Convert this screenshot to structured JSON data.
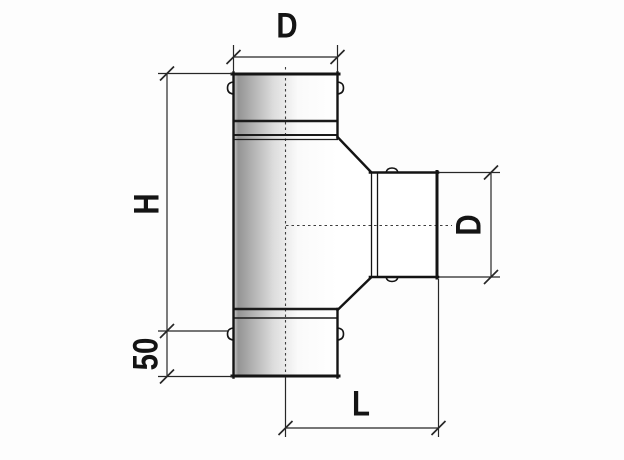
{
  "drawing": {
    "type": "engineering dimension drawing",
    "subject": "tee pipe fitting, front view",
    "labels": {
      "top_diameter": "D",
      "height": "H",
      "branch_diameter": "D",
      "bottom_section": "50",
      "branch_length": "L"
    },
    "dimensions": [
      {
        "label": "D",
        "position": "top",
        "orientation": "horizontal"
      },
      {
        "label": "H",
        "position": "left",
        "orientation": "vertical"
      },
      {
        "label": "D",
        "position": "right",
        "orientation": "vertical"
      },
      {
        "label": "50",
        "position": "lower-left",
        "orientation": "vertical"
      },
      {
        "label": "L",
        "position": "bottom",
        "orientation": "horizontal"
      }
    ],
    "colors": {
      "background": "#fdfdfd",
      "outline": "#161616",
      "thin_line": "#272727",
      "pipe_shade_dark": "#949494",
      "pipe_shade_light": "#ffffff"
    }
  }
}
